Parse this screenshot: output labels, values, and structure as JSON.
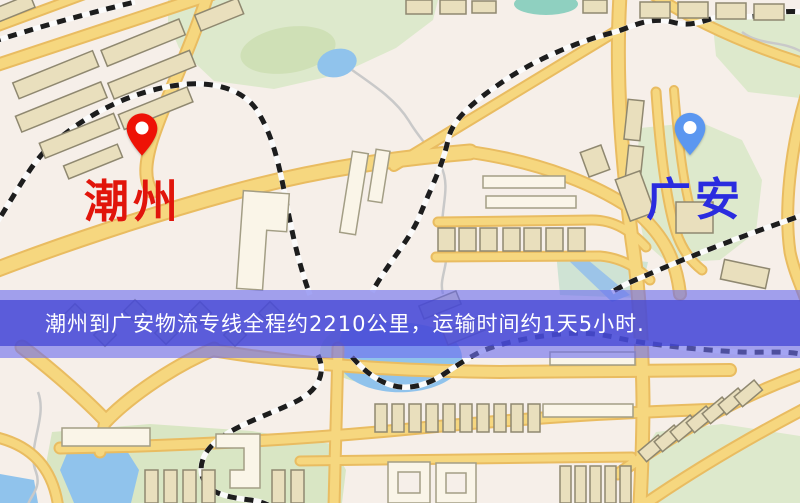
{
  "map": {
    "origin": {
      "name": "潮州",
      "pin_color": "#ee1206",
      "pin_hole_color": "#ffffff",
      "label_color": "#e1150b"
    },
    "destination": {
      "name": "广安",
      "pin_color": "#5b97f0",
      "pin_hole_color": "#ffffff",
      "label_color": "#2a2cdf"
    }
  },
  "banner": {
    "text": "潮州到广安物流专线全程约2210公里，运输时间约1天5小时.",
    "background_color": "#4042d2",
    "text_color": "#ffffff"
  },
  "map_colors": {
    "background": "#f6efe9",
    "road_fill": "#f6d77f",
    "road_casing": "#e9bc61",
    "building_fill": "#e9dfbd",
    "building_stroke": "#8f8870",
    "white_building_fill": "#faf5e8",
    "park_green": "#dde9cc",
    "dark_green": "#cfe0b6",
    "water_blue": "#90c3ec",
    "railway_dark": "#1d1d1d",
    "railway_light": "#fbfbfb"
  }
}
